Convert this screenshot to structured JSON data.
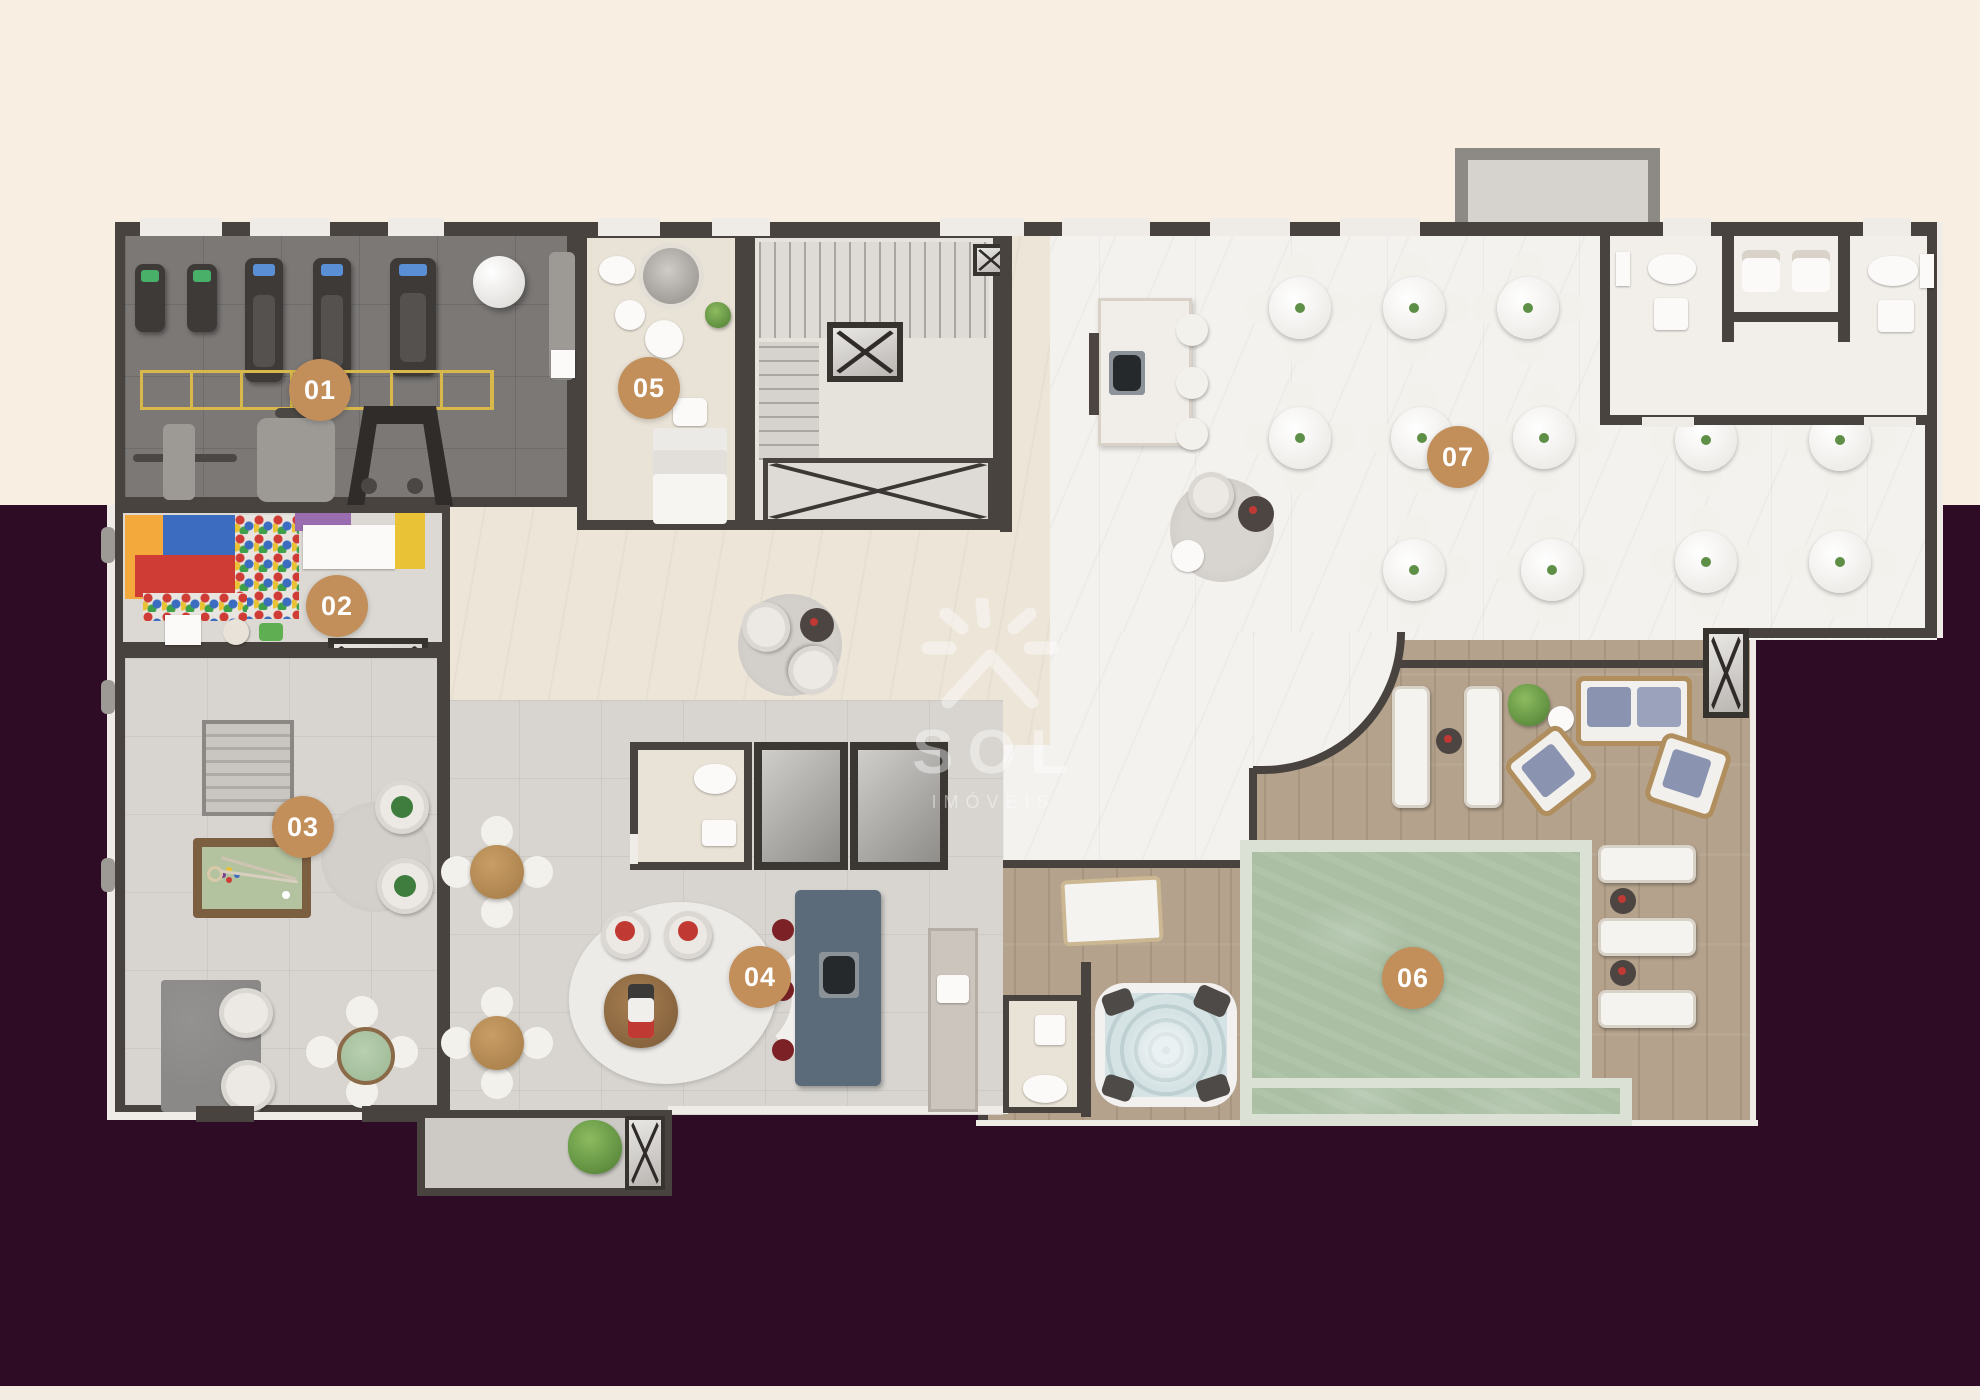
{
  "plan": {
    "badges": [
      {
        "label": "01"
      },
      {
        "label": "02"
      },
      {
        "label": "03"
      },
      {
        "label": "04"
      },
      {
        "label": "05"
      },
      {
        "label": "06"
      },
      {
        "label": "07"
      }
    ],
    "watermark": {
      "brand": "SOL",
      "tagline": "IMÓVEIS"
    },
    "colors": {
      "background_top": "#f8efe2",
      "background_main": "#2e0c26",
      "background_bottom_band": "#f3ece3",
      "badge": "#c28e59",
      "wall": "#49433f",
      "pool_water": "#aabfa4",
      "wood_deck": "#b4a28c",
      "kitchen_island": "#5c6b7a",
      "billiards_felt": "#b3c29f",
      "kids_red": "#cf3b35",
      "kids_blue": "#3c6cc0",
      "kids_yellow": "#e9c335",
      "kids_orange": "#f4a93c"
    }
  }
}
